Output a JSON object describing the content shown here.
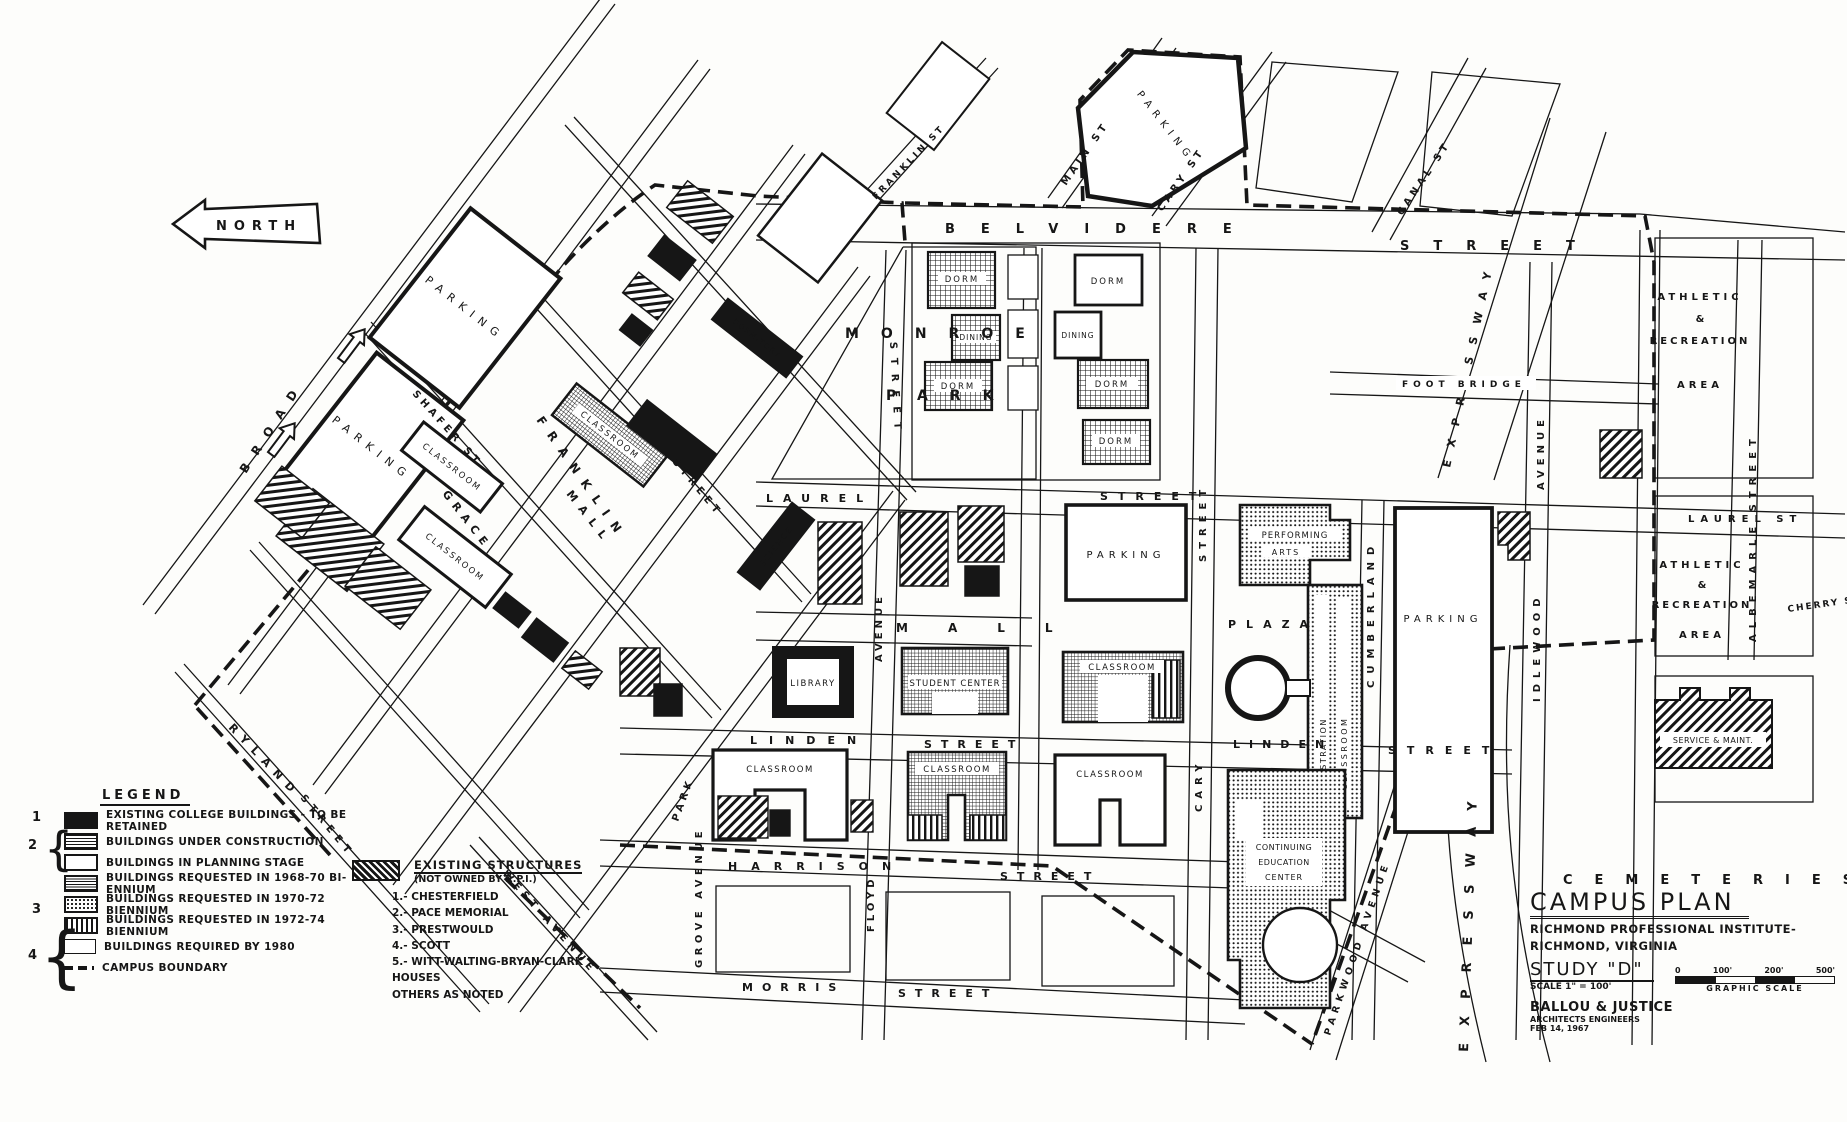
{
  "map": {
    "north_label": "NORTH",
    "streets": [
      {
        "label": "BROAD"
      },
      {
        "label": "GRACE"
      },
      {
        "label": "FRANKLIN"
      },
      {
        "label": "MALL"
      },
      {
        "label": "RYLAND"
      },
      {
        "label": "STREET"
      },
      {
        "label": "SHAFER ST"
      },
      {
        "label": "STREET"
      },
      {
        "label": "WEST AVENUE"
      },
      {
        "label": "PARK"
      },
      {
        "label": "GROVE AVENUE"
      },
      {
        "label": "BELVIDERE"
      },
      {
        "label": "STREET"
      },
      {
        "label": "MAIN ST"
      },
      {
        "label": "CARY ST"
      },
      {
        "label": "CANAL ST"
      },
      {
        "label": "FRANKLIN ST"
      },
      {
        "label": "LAUREL"
      },
      {
        "label": "STREET"
      },
      {
        "label": "LAUREL ST"
      },
      {
        "label": "MALL"
      },
      {
        "label": "AVENUE"
      },
      {
        "label": "FLOYD"
      },
      {
        "label": "LINDEN"
      },
      {
        "label": "STREET"
      },
      {
        "label": "LINDEN"
      },
      {
        "label": "STREET"
      },
      {
        "label": "HARRISON"
      },
      {
        "label": "STREET"
      },
      {
        "label": "MORRIS"
      },
      {
        "label": "STREET"
      },
      {
        "label": "STREET"
      },
      {
        "label": "CARY"
      },
      {
        "label": "CUMBERLAND"
      },
      {
        "label": "IDLEWOOD"
      },
      {
        "label": "AVENUE"
      },
      {
        "label": "PARKWOOD AVENUE"
      },
      {
        "label": "EXPRESSWAY"
      },
      {
        "label": "EXPRESSWAY"
      },
      {
        "label": "ALBEMARLE STREET"
      },
      {
        "label": "CHERRY ST"
      },
      {
        "label": "FOOT BRIDGE"
      },
      {
        "label": "STREET"
      }
    ],
    "areas": [
      {
        "label": "MONROE"
      },
      {
        "label": "PARK"
      },
      {
        "label": "PLAZA"
      },
      {
        "label": "ATHLETIC"
      },
      {
        "label": "&"
      },
      {
        "label": "RECREATION"
      },
      {
        "label": "AREA"
      },
      {
        "label": "ATHLETIC"
      },
      {
        "label": "&"
      },
      {
        "label": "RECREATION"
      },
      {
        "label": "AREA"
      },
      {
        "label": "CEMETERIES"
      }
    ],
    "buildings": [
      {
        "label": "PARKING"
      },
      {
        "label": "PARKING"
      },
      {
        "label": "CLASSROOM"
      },
      {
        "label": "CLASSROOM"
      },
      {
        "label": "CLASSROOM"
      },
      {
        "label": "SCIENCE"
      },
      {
        "label": "DORMITORY"
      },
      {
        "label": "PARKING"
      },
      {
        "label": "DORM"
      },
      {
        "label": "DINING"
      },
      {
        "label": "DORM"
      },
      {
        "label": "DORM"
      },
      {
        "label": "DINING"
      },
      {
        "label": "DORM"
      },
      {
        "label": "DORM"
      },
      {
        "label": "PARKING"
      },
      {
        "label": "LIBRARY"
      },
      {
        "label": "STUDENT CENTER"
      },
      {
        "label": "CLASSROOM"
      },
      {
        "label": "CLASSROOM"
      },
      {
        "label": "CLASSROOM"
      },
      {
        "label": "CLASSROOM"
      },
      {
        "label": "PERFORMING"
      },
      {
        "label": "ARTS"
      },
      {
        "label": "ADMINISTRATION"
      },
      {
        "label": "CLASSROOM"
      },
      {
        "label": "PARKING"
      },
      {
        "label": "SERVICE & MAINT."
      },
      {
        "label": "CONTINUING"
      },
      {
        "label": "EDUCATION"
      },
      {
        "label": "CENTER"
      }
    ]
  },
  "legend": {
    "heading": "LEGEND",
    "group_numbers": [
      "1",
      "2",
      "3",
      "4"
    ],
    "items": [
      {
        "label": "EXISTING COLLEGE BUILDINGS - TO BE RETAINED"
      },
      {
        "label": "BUILDINGS UNDER CONSTRUCTION"
      },
      {
        "label": "BUILDINGS IN PLANNING STAGE"
      },
      {
        "label": "BUILDINGS REQUESTED IN 1968-70 BI-ENNIUM"
      },
      {
        "label": "BUILDINGS REQUESTED IN 1970-72 BIENNIUM"
      },
      {
        "label": "BUILDINGS REQUESTED IN 1972-74 BIENNIUM"
      },
      {
        "label": "BUILDINGS REQUIRED BY 1980"
      },
      {
        "label": "CAMPUS BOUNDARY"
      }
    ]
  },
  "note": {
    "heading": "EXISTING STRUCTURES",
    "subheading": "(NOT OWNED BY R.P.I.)",
    "items": [
      {
        "label": "1.- CHESTERFIELD"
      },
      {
        "label": "2.- PACE MEMORIAL"
      },
      {
        "label": "3.- PRESTWOULD"
      },
      {
        "label": "4.- SCOTT"
      },
      {
        "label": "5.- WITT-WALTING-BRYAN-CLARK HOUSES"
      },
      {
        "label": "OTHERS AS NOTED"
      }
    ]
  },
  "title_block": {
    "title": "CAMPUS PLAN",
    "line1": "RICHMOND PROFESSIONAL INSTITUTE-",
    "line2": "RICHMOND, VIRGINIA",
    "study": "STUDY \"D\"",
    "scale_note": "SCALE 1\" = 100'",
    "scale_ticks": [
      "0",
      "100'",
      "200'",
      "500'"
    ],
    "graphic_scale_label": "GRAPHIC SCALE",
    "firm": "BALLOU & JUSTICE",
    "firm_sub": "ARCHITECTS   ENGINEERS",
    "date": "FEB 14, 1967"
  }
}
